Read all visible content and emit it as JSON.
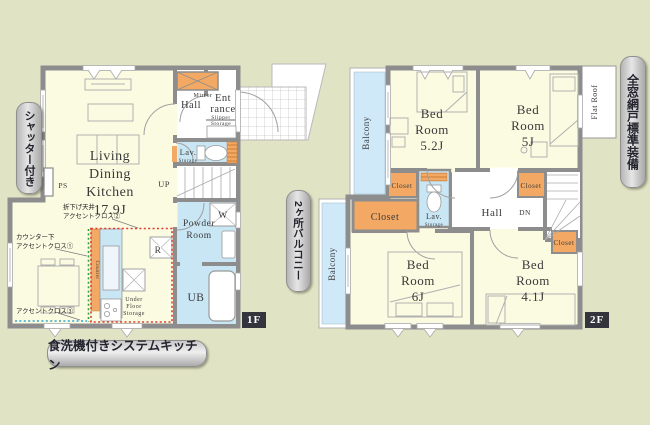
{
  "palette": {
    "background": "#e1e3c5",
    "room_cream": "#fbfbe2",
    "wall_gray": "#8d8d8d",
    "water_blue": "#c9e6f4",
    "balcony_blue": "#cfe9f8",
    "closet_orange": "#f3a963",
    "accent_red_dotted": "#e0392e",
    "accent_green_dotted": "#2fa33a",
    "accent_blue_dotted": "#2fa6cc",
    "badge_dark": "#34343c"
  },
  "side_labels": {
    "shutter": "シャッター付き",
    "two_balconies": "2ヶ所バルコニー",
    "window_screens": "全窓網戸標準装備",
    "system_kitchen": "食洗機付きシステムキッチン"
  },
  "badges": {
    "f1": "1F",
    "f2": "2F"
  },
  "floor1": {
    "ldk": [
      "Living",
      "Dining",
      "Kitchen",
      "17.9J"
    ],
    "hall": "Hall",
    "entrance": [
      "Ent",
      "rance"
    ],
    "mirror": "Mirror",
    "slipper": [
      "Slipper",
      "Storage"
    ],
    "lav": "Lav.",
    "lav_storage": "Storage",
    "up": "UP",
    "ps": "PS",
    "w": "W",
    "powder": [
      "Powder",
      "Room"
    ],
    "ub": "UB",
    "r": "R",
    "under_floor": [
      "Under",
      "Floor",
      "Storage"
    ],
    "counter": "Counter",
    "ann_ceiling": [
      "折下げ天井",
      "アクセントクロス②"
    ],
    "ann_counter": [
      "カウンター下",
      "アクセントクロス①"
    ],
    "ann_wall": "アクセントクロス③"
  },
  "floor2": {
    "balcony_upper": "Balcony",
    "balcony_lower": "Balcony",
    "flat_roof": "Flat Roof",
    "bed_52": [
      "Bed",
      "Room",
      "5.2J"
    ],
    "bed_5": [
      "Bed",
      "Room",
      "5J"
    ],
    "bed_6": [
      "Bed",
      "Room",
      "6J"
    ],
    "bed_41": [
      "Bed",
      "Room",
      "4.1J"
    ],
    "closet": "Closet",
    "lav": "Lav.",
    "lav_storage": "Storage",
    "hall": "Hall",
    "dn": "DN"
  }
}
